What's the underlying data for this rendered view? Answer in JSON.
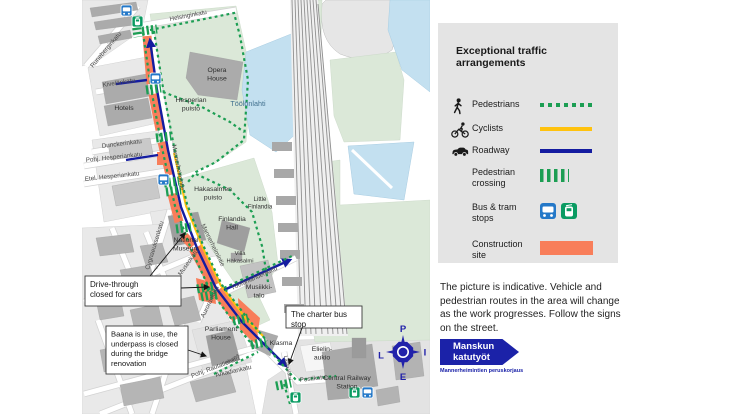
{
  "colors": {
    "pedestrian_green": "#1c9e53",
    "cyclist_yellow": "#ffc20e",
    "roadway_blue": "#141ca0",
    "construction_orange": "#f87e5a",
    "bus_blue": "#2478c8",
    "tram_green": "#0a9b62",
    "compass_blue": "#2121aa",
    "sign_blue": "#1b22a8",
    "water": "#c3e0f0",
    "park": "#dbe8d8"
  },
  "legend": {
    "title": "Exceptional traffic arrangements",
    "items": [
      {
        "id": "pedestrians",
        "label": "Pedestrians",
        "swatch": "dotted-green"
      },
      {
        "id": "cyclists",
        "label": "Cyclists",
        "swatch": "yellow-line"
      },
      {
        "id": "roadway",
        "label": "Roadway",
        "swatch": "blue-line"
      },
      {
        "id": "pedestrian-crossing",
        "label": "Pedestrian crossing",
        "swatch": "crossing-bars"
      },
      {
        "id": "bus-tram-stops",
        "label": "Bus & tram stops",
        "swatch": "stop-icons"
      },
      {
        "id": "construction-site",
        "label": "Construction site",
        "swatch": "orange-block"
      }
    ]
  },
  "note": "The picture is indicative. Vehicle and pedestrian routes in the area will change as the work progresses. Follow the signs on the street.",
  "sign": {
    "title_line1": "Manskun",
    "title_line2": "katutyöt",
    "subtitle": "Mannerheimintien peruskorjaus"
  },
  "compass": {
    "north": "P",
    "east": "I",
    "south": "E",
    "west": "L"
  },
  "map": {
    "street_labels": [
      {
        "text": "Helsinginkatu",
        "x": 170,
        "y": 21,
        "rot": -11,
        "size": 6.3
      },
      {
        "text": "Runeberginkatu",
        "x": 93,
        "y": 68,
        "rot": -50,
        "size": 6.3
      },
      {
        "text": "Kivelänkatu",
        "x": 103,
        "y": 87,
        "rot": -9,
        "size": 6.3
      },
      {
        "text": "Dunckerinkatu",
        "x": 102,
        "y": 148,
        "rot": -7,
        "size": 6.3
      },
      {
        "text": "Pohj. Hesperiankatu",
        "x": 86,
        "y": 162,
        "rot": -6,
        "size": 6.3
      },
      {
        "text": "Etel. Hesperiankatu",
        "x": 85,
        "y": 181,
        "rot": -6,
        "size": 6.3
      },
      {
        "text": "Mannerheimintie",
        "x": 172,
        "y": 145,
        "rot": 79,
        "size": 6.3
      },
      {
        "text": "Mannerheimintie",
        "x": 201,
        "y": 225,
        "rot": 64,
        "size": 6.3
      },
      {
        "text": "Museokatu",
        "x": 181,
        "y": 276,
        "rot": -55,
        "size": 6.3
      },
      {
        "text": "Cygnaeuksenkatu",
        "x": 149,
        "y": 270,
        "rot": -73,
        "size": 6.3
      },
      {
        "text": "Aurorankatu",
        "x": 204,
        "y": 318,
        "rot": -64,
        "size": 6.3
      },
      {
        "text": "Töölönlahdenkatu",
        "x": 232,
        "y": 290,
        "rot": -24,
        "size": 6.3
      },
      {
        "text": "Pohj. Rautatiekatu",
        "x": 192,
        "y": 378,
        "rot": -21,
        "size": 6.3
      },
      {
        "text": "Baana",
        "x": 227,
        "y": 365,
        "rot": -36,
        "size": 5.3
      },
      {
        "text": "Arkadiankatu",
        "x": 216,
        "y": 377,
        "rot": -13,
        "size": 6.3
      },
      {
        "text": "Lasipalatsi",
        "x": 284,
        "y": 356,
        "rot": 79,
        "size": 5.3
      },
      {
        "text": "Postikatu",
        "x": 300,
        "y": 382,
        "rot": -7,
        "size": 6.3
      }
    ],
    "area_labels": [
      {
        "lines": [
          "Opera",
          "House"
        ],
        "x": 217,
        "y": 72,
        "size": 6.8
      },
      {
        "lines": [
          "Hotels"
        ],
        "x": 124,
        "y": 110,
        "size": 6.8
      },
      {
        "lines": [
          "Hesperian",
          "puisto"
        ],
        "x": 191,
        "y": 102,
        "size": 6.8
      },
      {
        "lines": [
          "Töölönlahti"
        ],
        "x": 248,
        "y": 106,
        "size": 7.2,
        "water": true
      },
      {
        "lines": [
          "Hakasalmen",
          "puisto"
        ],
        "x": 213,
        "y": 191,
        "size": 6.8
      },
      {
        "lines": [
          "Little",
          "Finlandia"
        ],
        "x": 260,
        "y": 201,
        "size": 6
      },
      {
        "lines": [
          "Finlandia",
          "Hall"
        ],
        "x": 232,
        "y": 221,
        "size": 6.8
      },
      {
        "lines": [
          "Villa",
          "Hakasalmi"
        ],
        "x": 240,
        "y": 255,
        "size": 5.8
      },
      {
        "lines": [
          "National",
          "Museum"
        ],
        "x": 186,
        "y": 242,
        "size": 6.8
      },
      {
        "lines": [
          "Musiikki-",
          "talo"
        ],
        "x": 259,
        "y": 289,
        "size": 6.8
      },
      {
        "lines": [
          "Kiasma"
        ],
        "x": 281,
        "y": 345,
        "size": 6.8
      },
      {
        "lines": [
          "Parliament",
          "House"
        ],
        "x": 221,
        "y": 331,
        "size": 6.8
      },
      {
        "lines": [
          "Elielin-",
          "aukio"
        ],
        "x": 322,
        "y": 351,
        "size": 6.8
      },
      {
        "lines": [
          "Central Railway",
          "Station"
        ],
        "x": 347,
        "y": 380,
        "size": 6.8
      }
    ],
    "callouts": [
      {
        "id": "drive-through",
        "lines": [
          "Drive-through",
          "closed for cars"
        ],
        "x": 85,
        "y": 276,
        "w": 96,
        "h": 30,
        "size": 8,
        "leaders": [
          [
            181,
            288,
            209,
            287
          ],
          [
            150,
            276,
            185,
            233
          ]
        ]
      },
      {
        "id": "baana",
        "lines": [
          "Baana is in use, the",
          "underpass is closed",
          "during the bridge",
          "renovation"
        ],
        "x": 106,
        "y": 326,
        "w": 82,
        "h": 48,
        "size": 7.6,
        "leaders": [
          [
            188,
            350,
            206,
            356
          ]
        ]
      },
      {
        "id": "charter-bus",
        "lines": [
          "The charter bus",
          "stop"
        ],
        "x": 286,
        "y": 306,
        "w": 76,
        "h": 22,
        "size": 8,
        "leaders": [
          [
            302,
            328,
            289,
            364
          ]
        ]
      }
    ],
    "stops": [
      {
        "type": "bus",
        "x": 121,
        "y": 5
      },
      {
        "type": "tram",
        "x": 132,
        "y": 16
      },
      {
        "type": "bus",
        "x": 150,
        "y": 73
      },
      {
        "type": "bus",
        "x": 158,
        "y": 174
      },
      {
        "type": "tram",
        "x": 290,
        "y": 392
      },
      {
        "type": "tram",
        "x": 349,
        "y": 387
      },
      {
        "type": "bus",
        "x": 362,
        "y": 387
      }
    ]
  }
}
